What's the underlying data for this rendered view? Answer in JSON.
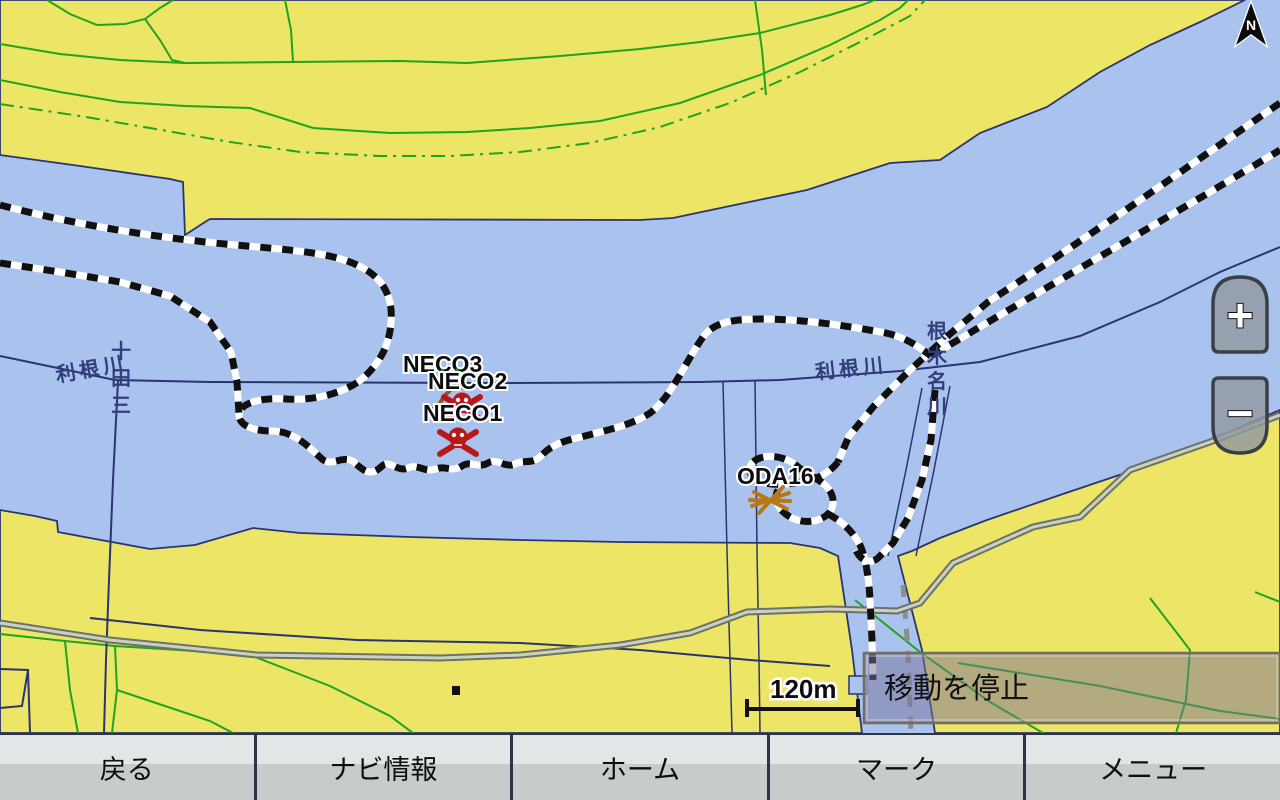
{
  "map": {
    "labels": {
      "river_tone_west": "利根川",
      "river_tone_east": "利根川",
      "boundary_vertical": "十田三",
      "river_nekoname": "根木名川"
    },
    "waypoints": [
      {
        "label": "NECO3",
        "icon": "palm-tree-icon"
      },
      {
        "label": "NECO2",
        "icon": "skull-crossbones-icon"
      },
      {
        "label": "NECO1",
        "icon": "skull-crossbones-icon"
      },
      {
        "label": "ODA16",
        "icon": "crossed-sticks-icon"
      }
    ],
    "scale": {
      "label": "120m"
    },
    "north_label": "N",
    "zoom_in": "+",
    "zoom_out": "−"
  },
  "overlay": {
    "stop_label": "移動を停止"
  },
  "bottom_bar": {
    "buttons": [
      "戻る",
      "ナビ情報",
      "ホーム",
      "マーク",
      "メニュー"
    ]
  },
  "colors": {
    "water": "#a9c3ee",
    "land": "#ece566",
    "coastline": "#2b3472",
    "field_lines": "#1ea41e",
    "road": "#6b7266",
    "track_black": "#101010",
    "track_white": "#ffffff",
    "skull_red": "#b81818",
    "palm_green": "#1e9e1e",
    "sticks_orange": "#b87818",
    "bar_top": "#e1e6e6",
    "bar_bottom": "#c6cccc"
  }
}
